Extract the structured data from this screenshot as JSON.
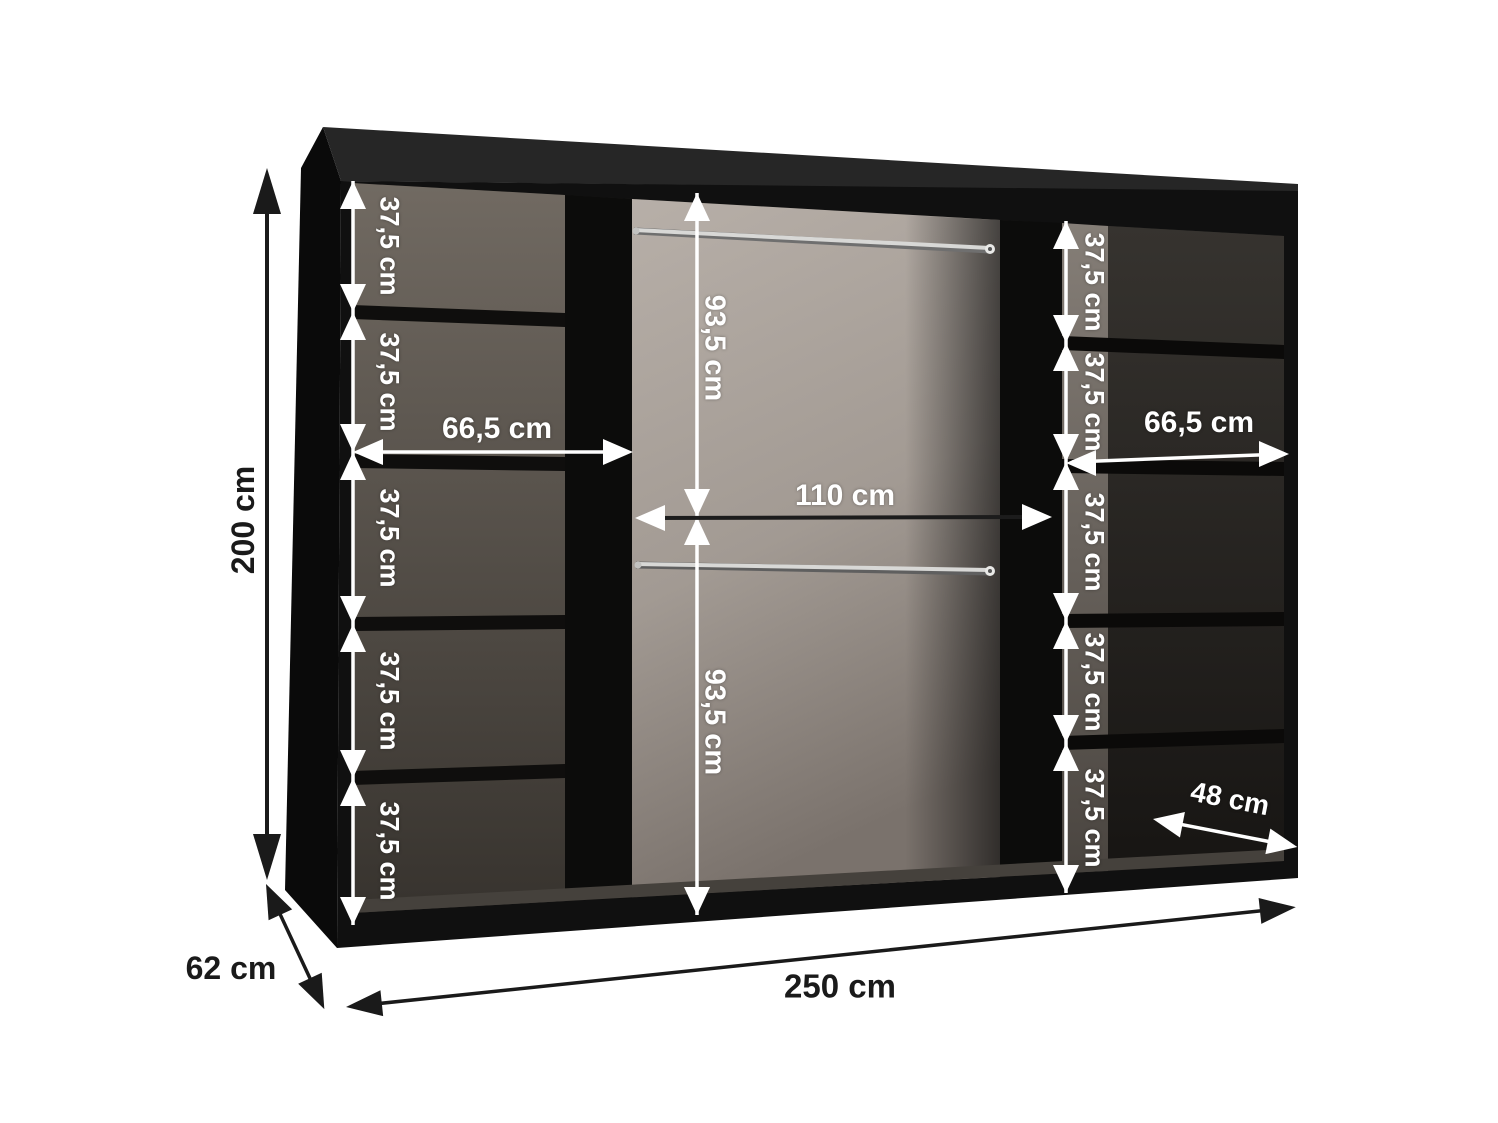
{
  "diagram_type": "wardrobe-interior-dimensions",
  "dimensions": {
    "height": "200 cm",
    "depth": "62 cm",
    "width": "250 cm",
    "left_shelf_width": "66,5 cm",
    "right_shelf_width": "66,5 cm",
    "middle_width": "110 cm",
    "upper_hanging_height": "93,5 cm",
    "lower_hanging_height": "93,5 cm",
    "right_compartment_depth": "48 cm",
    "left_shelf_gaps": [
      "37,5 cm",
      "37,5 cm",
      "37,5 cm",
      "37,5 cm",
      "37,5 cm"
    ],
    "right_shelf_gaps": [
      "37,5 cm",
      "37,5 cm",
      "37,5 cm",
      "37,5 cm",
      "37,5 cm"
    ]
  },
  "colors": {
    "background": "#ffffff",
    "cabinet_black": "#111111",
    "interior_light_panel": "#b3aba4",
    "interior_dark_panel": "#3a3631",
    "dimension_white": "#ffffff",
    "dimension_black": "#1a1a1a",
    "rail_silver": "#d8d8d6"
  }
}
